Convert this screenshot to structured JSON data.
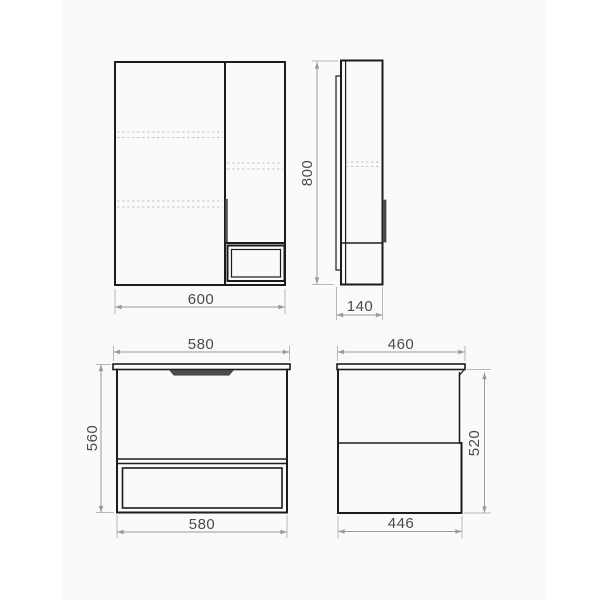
{
  "views": {
    "mirror_cabinet_front": {
      "width": "600"
    },
    "mirror_cabinet_side": {
      "height": "800",
      "depth": "140"
    },
    "vanity_front": {
      "top_width": "580",
      "height": "560",
      "bottom_width": "580"
    },
    "vanity_side": {
      "top_depth": "460",
      "height": "520",
      "bottom_depth": "446"
    }
  },
  "colors": {
    "line": "#1c1c1c",
    "dim_line": "#9a9a9a",
    "ext_line": "#b8b8b8",
    "dash_line": "#c4c4c4",
    "label_text": "#4a4a4a",
    "handle_fill": "#4d4d4d",
    "canvas": "#fafafa"
  }
}
